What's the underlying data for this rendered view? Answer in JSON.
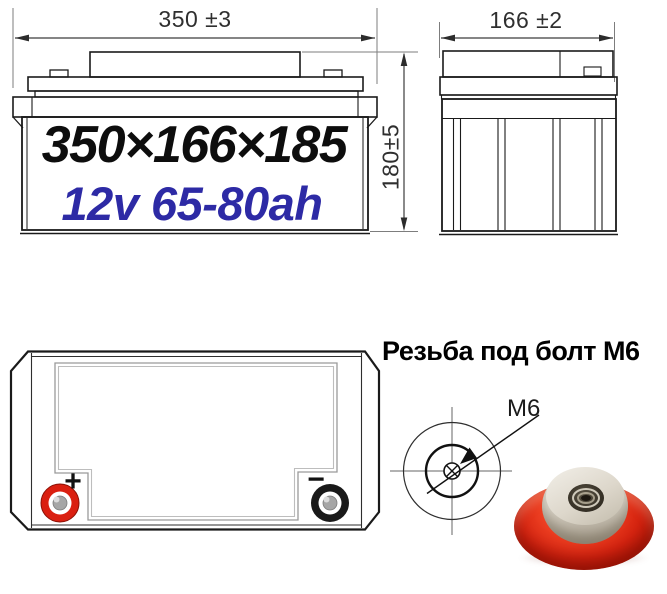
{
  "dims": {
    "front_width": "350 ±3",
    "side_width": "166 ±2",
    "height": "180±5"
  },
  "battery": {
    "size_label": "350×166×185",
    "capacity_label": "12v 65-80ah"
  },
  "terminals": {
    "positive_sign": "+",
    "negative_sign": "−"
  },
  "thread": {
    "title": "Резьба под болт М6",
    "callout": "M6"
  },
  "colors": {
    "size_black": "#0d0d0d",
    "capacity_blue": "#2d2aa5",
    "dimension_gray": "#2f2f2f",
    "terminal_positive_red": "#da1f10",
    "terminal_negative_black": "#191919",
    "nut_red": "#d62410",
    "nut_metal": "#cfc8ba",
    "line_color": "#1a1a1a"
  }
}
